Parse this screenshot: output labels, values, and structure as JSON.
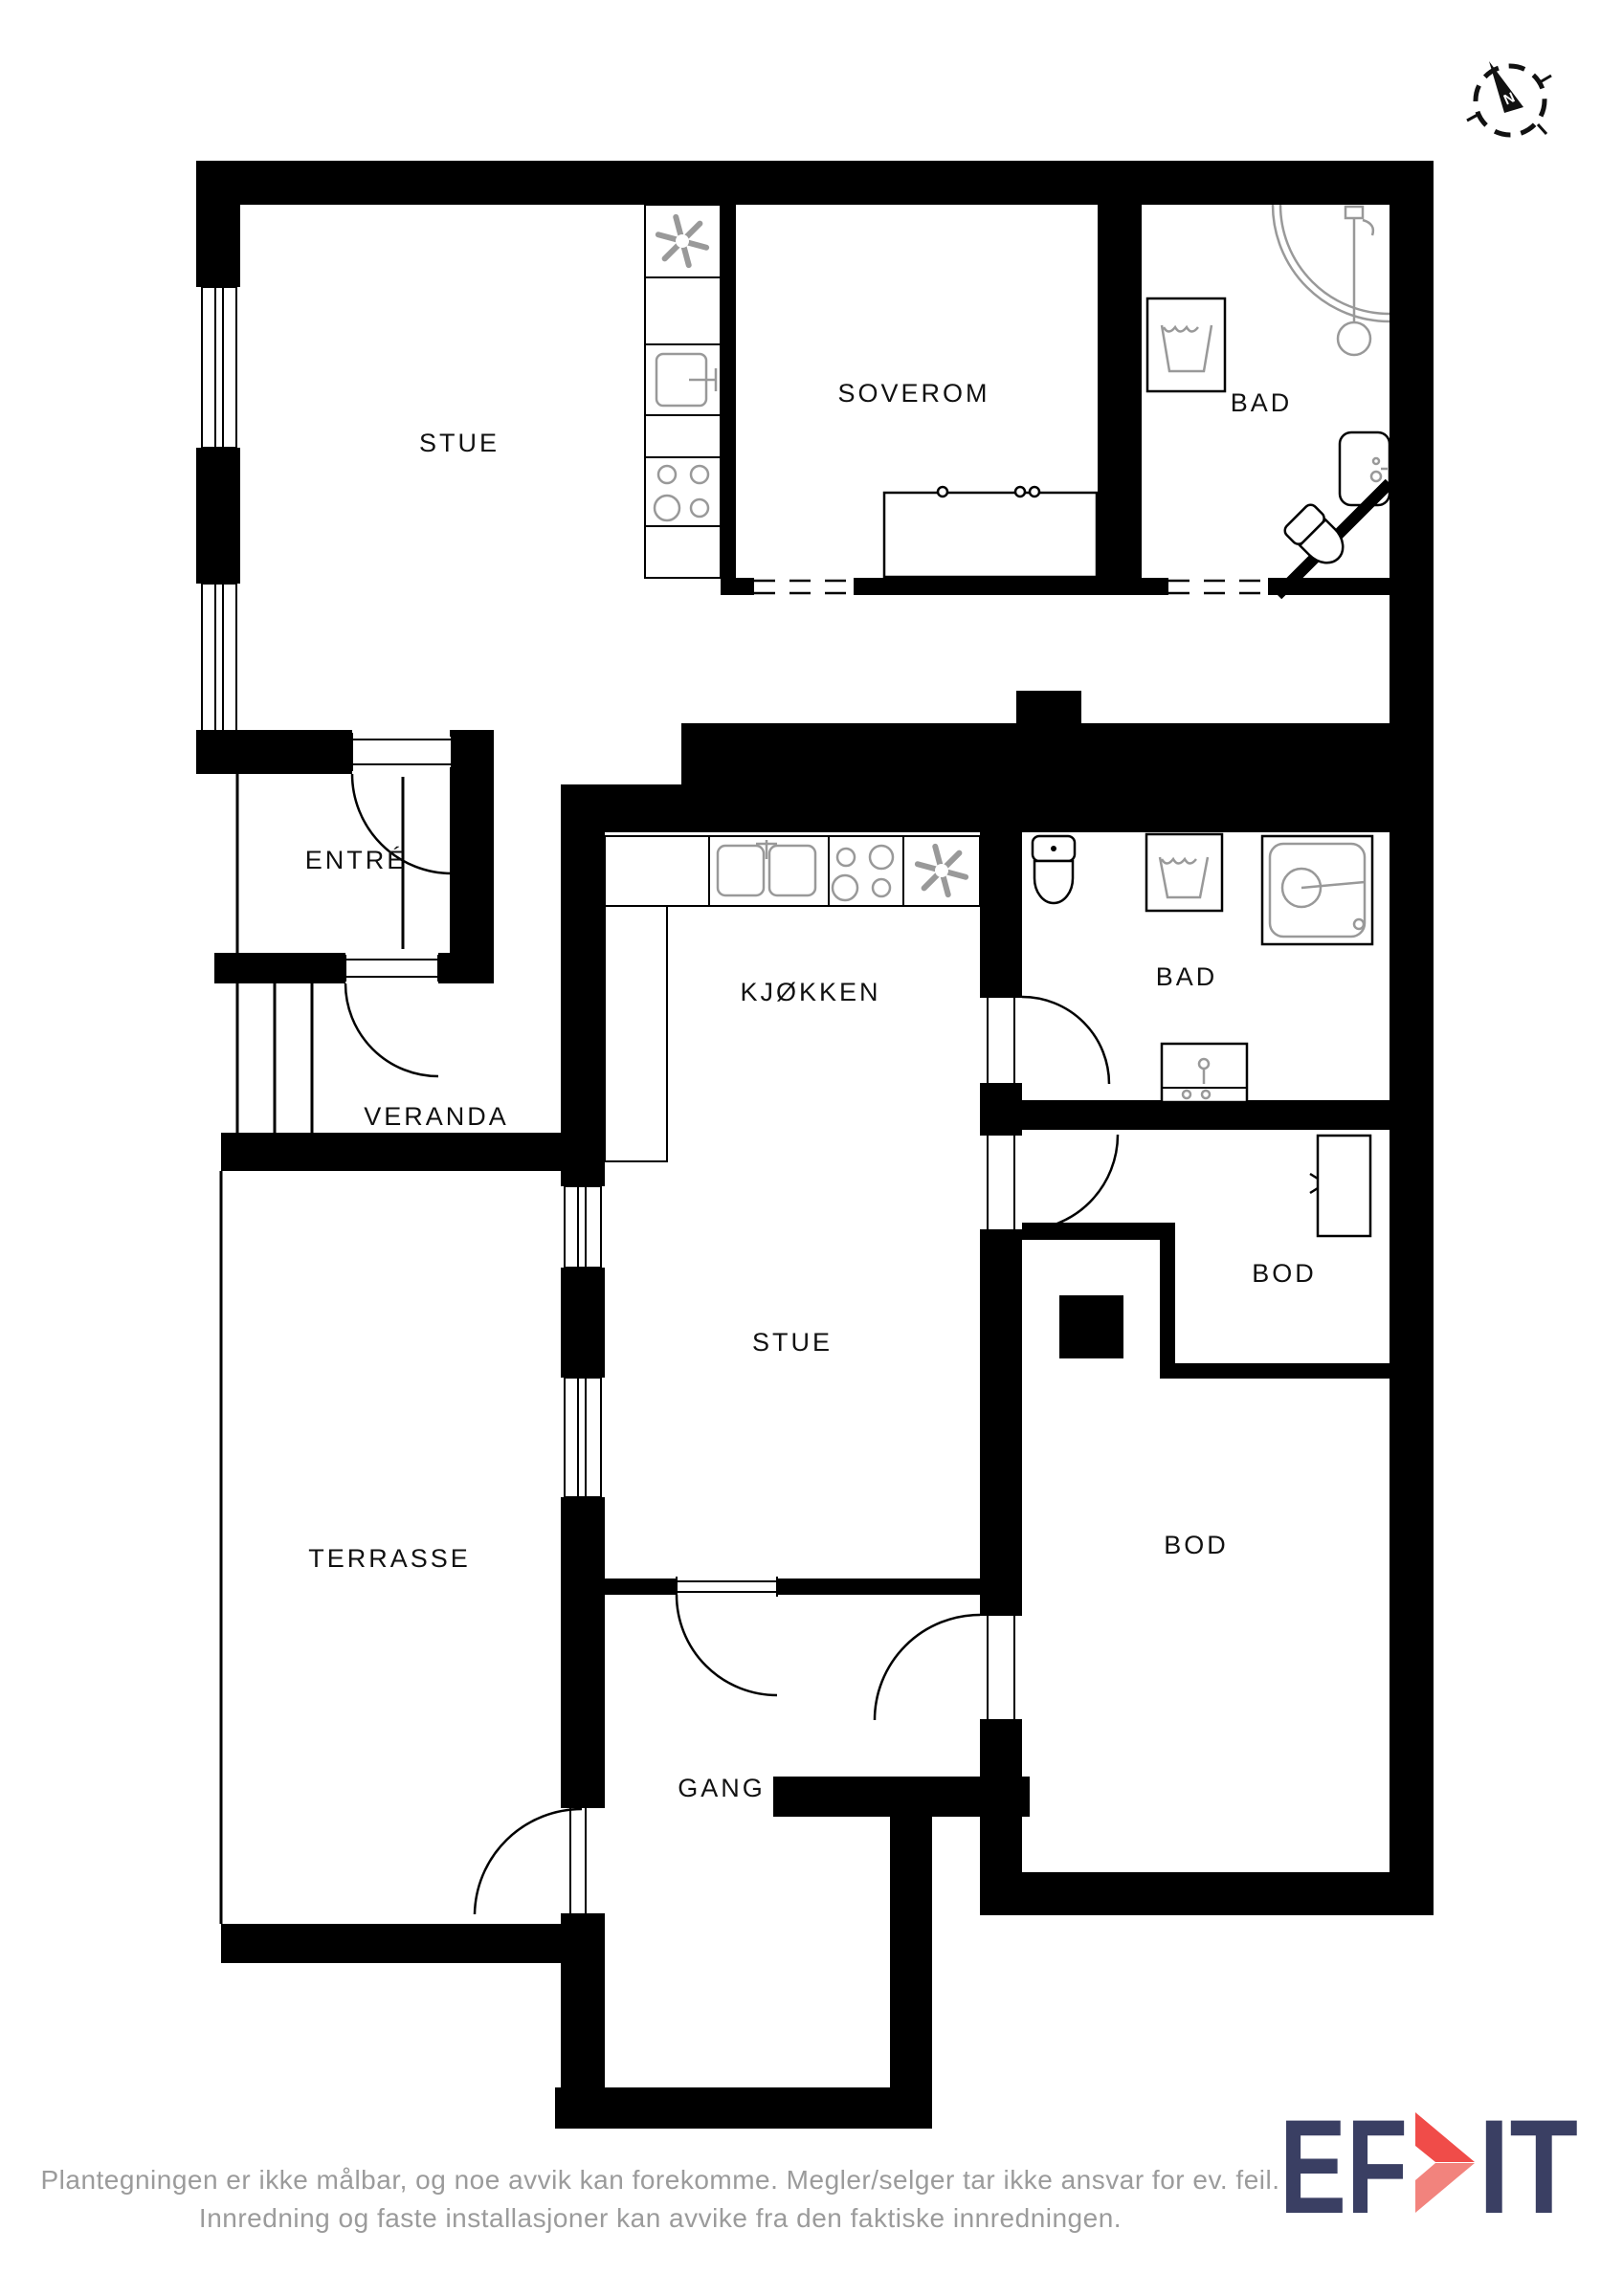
{
  "plan": {
    "rooms": [
      {
        "id": "stue-top",
        "label": "STUE"
      },
      {
        "id": "soverom",
        "label": "SOVEROM"
      },
      {
        "id": "bad-top",
        "label": "BAD"
      },
      {
        "id": "entre",
        "label": "ENTRÉ"
      },
      {
        "id": "veranda",
        "label": "VERANDA"
      },
      {
        "id": "kjokken",
        "label": "KJØKKEN"
      },
      {
        "id": "bad-mid",
        "label": "BAD"
      },
      {
        "id": "bod-small",
        "label": "BOD"
      },
      {
        "id": "stue-mid",
        "label": "STUE"
      },
      {
        "id": "terrasse",
        "label": "TERRASSE"
      },
      {
        "id": "bod-large",
        "label": "BOD"
      },
      {
        "id": "gang",
        "label": "GANG"
      }
    ],
    "wall_color": "#000000",
    "fixture_color": "#999999"
  },
  "compass": {
    "north_label": "N"
  },
  "footer": {
    "line1": "Plantegningen er ikke målbar, og noe avvik kan forekomme. Megler/selger tar ikke ansvar for ev. feil.",
    "line2": "Innredning og faste installasjoner kan avvike fra den faktiske innredningen."
  },
  "logo": {
    "part1": "EF",
    "part2": "IT",
    "navy": "#3a3f63",
    "red_top": "#f04c49",
    "red_bottom": "#f2837d"
  }
}
